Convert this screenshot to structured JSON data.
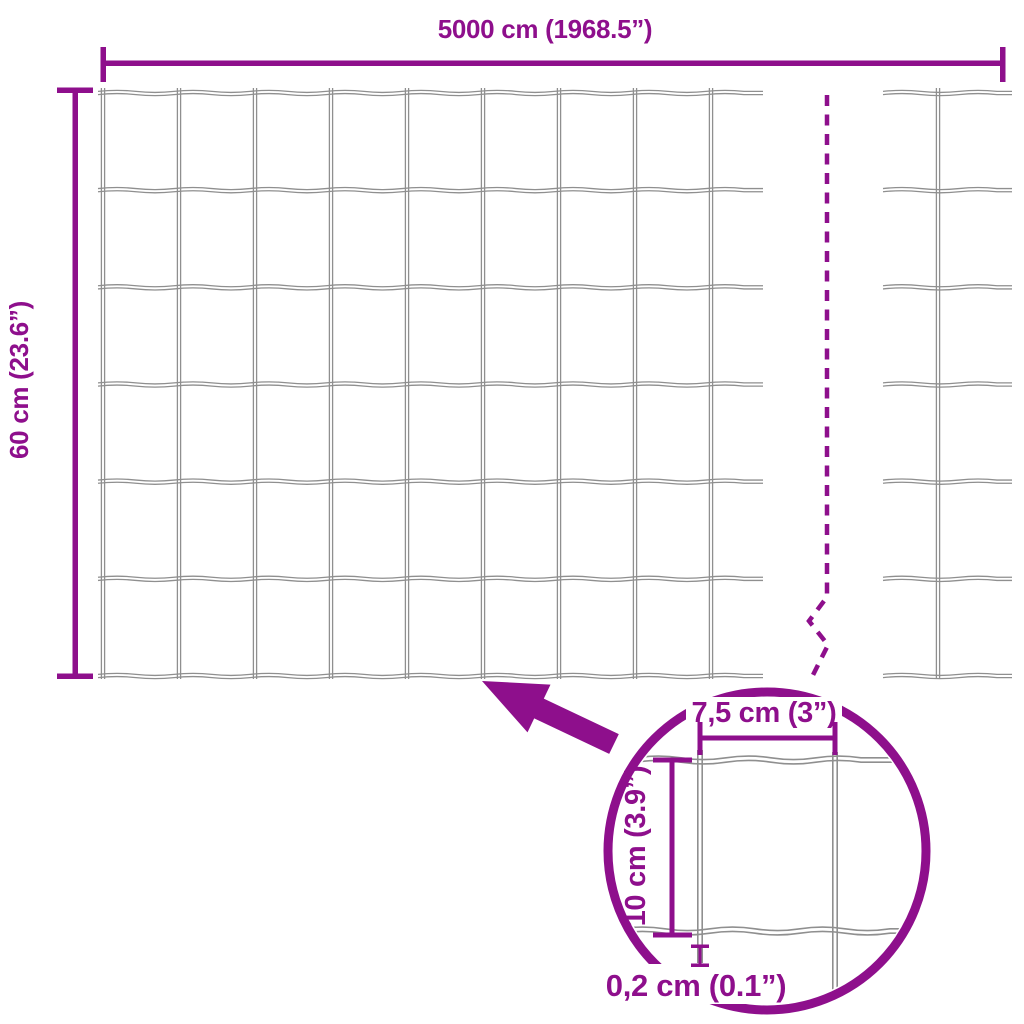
{
  "diagram": {
    "type": "product-dimension-diagram",
    "subject": "garden wire mesh fence roll",
    "colors": {
      "accent": "#8E0F8C",
      "wire": "#8F8F8F",
      "background": "#FFFFFF"
    },
    "dimensions": {
      "total_width": "5000 cm (1968.5”)",
      "total_height": "60 cm (23.6”)",
      "mesh_cell_width": "7,5 cm (3”)",
      "mesh_cell_height": "10 cm (3.9”)",
      "wire_thickness": "0,2 cm (0.1”)"
    },
    "mesh": {
      "main_rows": 6,
      "main_cols": 8
    }
  }
}
